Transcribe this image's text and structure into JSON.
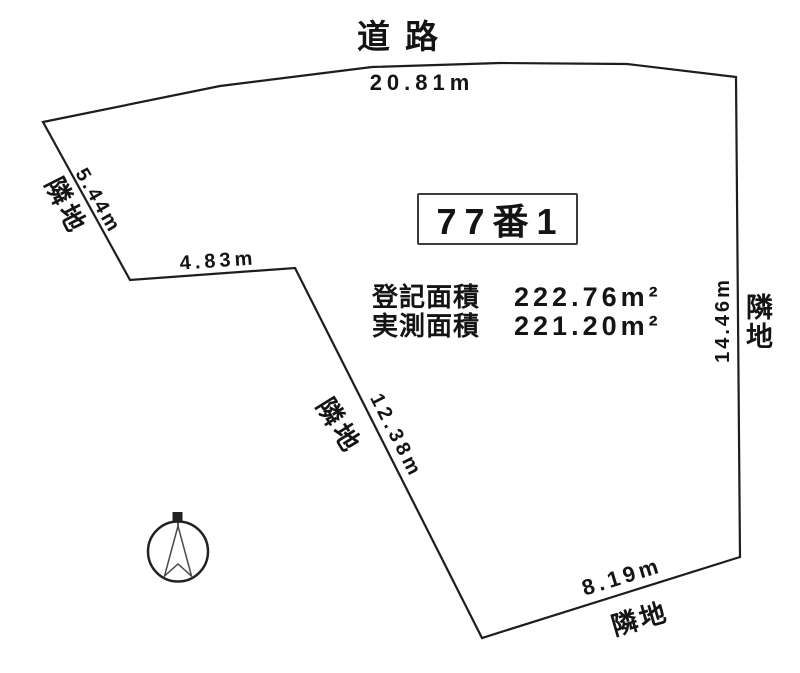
{
  "colors": {
    "ink": "#1d1d1d",
    "background": "#ffffff",
    "text": "#141414"
  },
  "labels": {
    "road": "道路",
    "parcel_number": "77番1"
  },
  "areas": {
    "registered_label": "登記面積",
    "registered_value": "222.76m²",
    "measured_label": "実測面積",
    "measured_value": "221.20m²"
  },
  "dimensions": {
    "top_edge": "20.81m",
    "upper_left_edge": "5.44m",
    "mid_left_edge": "4.83m",
    "diagonal_edge": "12.38m",
    "right_edge": "14.46m",
    "bottom_edge": "8.19m"
  },
  "neighbors": {
    "upper_left": "隣地",
    "middle": "隣地",
    "right": "隣地",
    "bottom": "隣地"
  },
  "icons": {
    "compass": "north-compass"
  }
}
